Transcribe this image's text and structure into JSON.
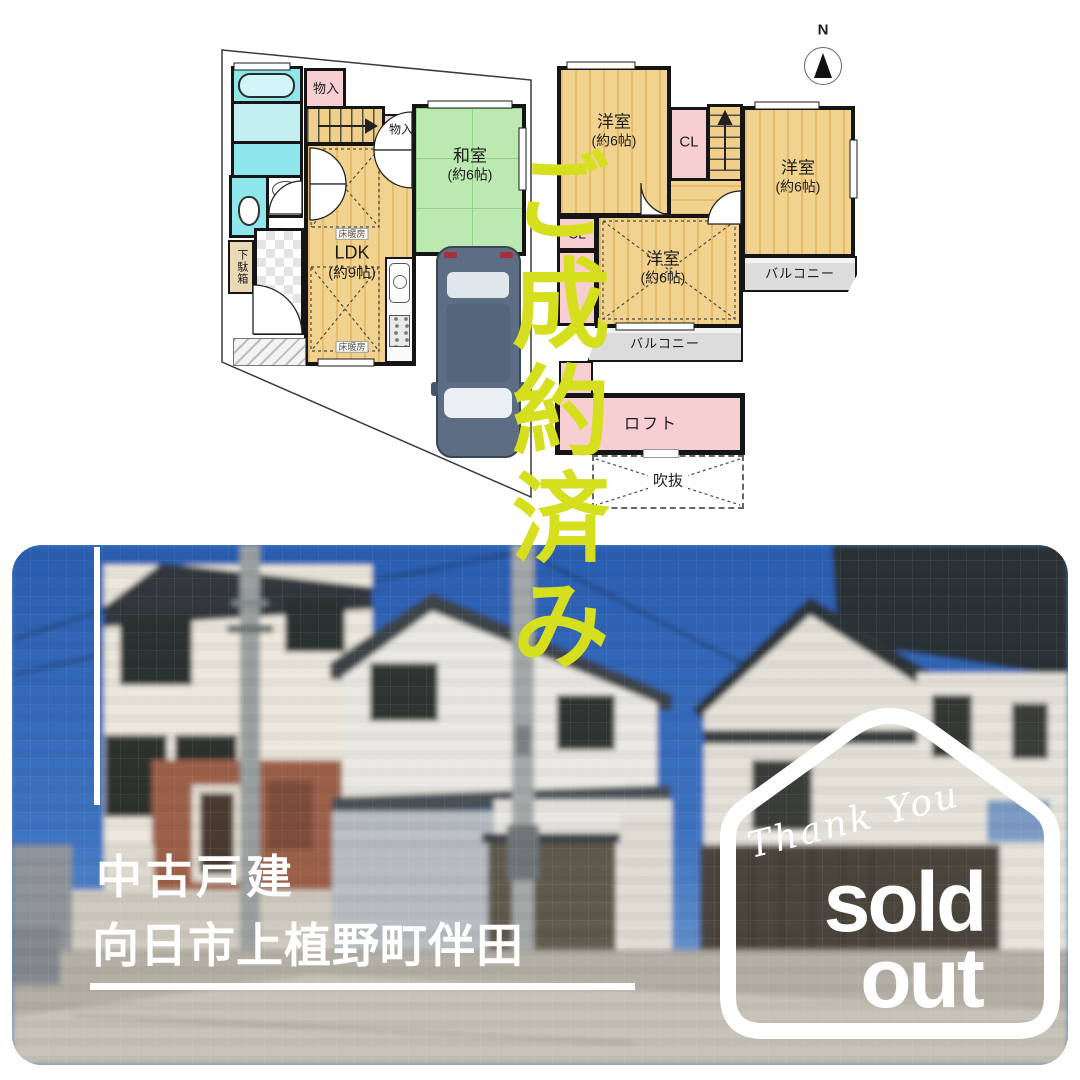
{
  "stamp": {
    "text": "ご成約済み"
  },
  "floorplan": {
    "compass": "N",
    "floor1": {
      "closet1": "物入",
      "closet2": "物入",
      "japanese_room": {
        "name": "和室",
        "size": "(約6帖)"
      },
      "ldk": {
        "name": "LDK",
        "size": "(約9帖)"
      },
      "floor_heating_1": "床暖房",
      "floor_heating_2": "床暖房",
      "shoe_cabinet": "下駄箱"
    },
    "floor2": {
      "bedroom_nw": {
        "name": "洋室",
        "size": "(約6帖)"
      },
      "bedroom_e": {
        "name": "洋室",
        "size": "(約6帖)"
      },
      "bedroom_s": {
        "name": "洋室",
        "size": "(約6帖)"
      },
      "closet_center": "CL",
      "closet_west": "CL",
      "balcony_east": "バルコニー",
      "balcony_south": "バルコニー"
    },
    "loft": "ロフト",
    "void": "吹抜"
  },
  "photo": {
    "property_type": "中古戸建",
    "address": "向日市上植野町伴田"
  },
  "badge": {
    "script_text": "Thank You",
    "word1": "sold",
    "word2": "out"
  },
  "colors": {
    "stamp_green": "#d6df1e",
    "wood_floor": "#eecb81",
    "tatami_green": "#bce8b2",
    "closet_pink": "#f7cfd2",
    "bath_cyan": "#8fe6ec",
    "balcony_gray": "#dcdcdc",
    "sky_blue": "#2c63b5",
    "text_white": "#ffffff"
  }
}
